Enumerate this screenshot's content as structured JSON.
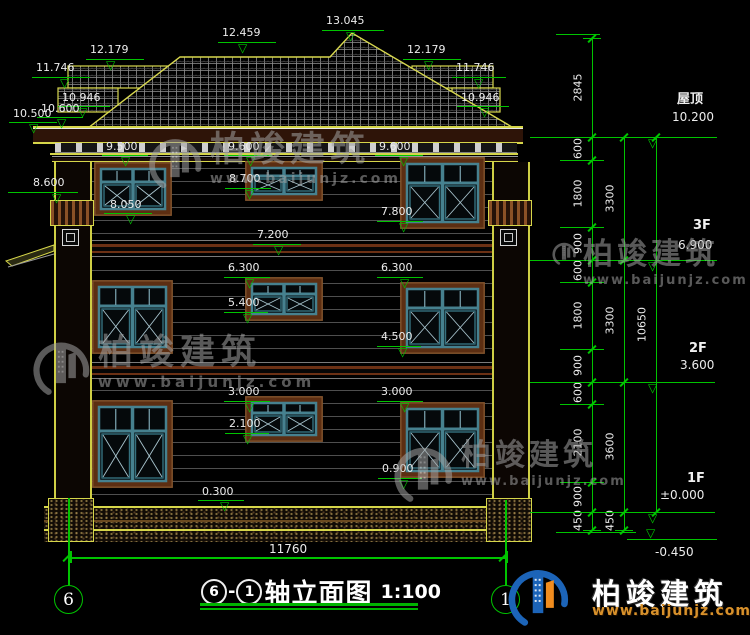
{
  "title": {
    "axis_a": "6",
    "axis_b": "1",
    "dash": "-",
    "name": "轴立面图",
    "scale": "1:100",
    "axis_left_bubble": "6",
    "axis_right_bubble": "1"
  },
  "overall_dim": "11760",
  "brand": {
    "name": "柏竣建筑",
    "url": "www.baijunjz.com"
  },
  "colors": {
    "green": "#00c400",
    "yellow": "#d6d64a",
    "brown": "#5c2e12",
    "teal": "#46818f",
    "watermark": "#a2a2a2",
    "logo_blue": "#1c64b8",
    "logo_orange": "#f08c1e",
    "url_orange": "#d8912b"
  },
  "markers": [
    {
      "t": "13.045",
      "x": 326,
      "y": 15,
      "lx": 322,
      "ly": 30,
      "lw": 62,
      "ax": 346
    },
    {
      "t": "12.459",
      "x": 222,
      "y": 27,
      "lx": 218,
      "ly": 42,
      "lw": 58,
      "ax": 238
    },
    {
      "t": "12.179",
      "x": 90,
      "y": 44,
      "lx": 86,
      "ly": 59,
      "lw": 58,
      "ax": 106
    },
    {
      "t": "11.746",
      "x": 36,
      "y": 62,
      "lx": 32,
      "ly": 77,
      "lw": 58,
      "ax": 60
    },
    {
      "t": "10.946",
      "x": 62,
      "y": 92,
      "lx": 58,
      "ly": 106,
      "lw": 52,
      "ax": 78
    },
    {
      "t": "10.600",
      "x": 41,
      "y": 103,
      "lx": 37,
      "ly": 117,
      "lw": 46,
      "ax": 57
    },
    {
      "t": "10.500",
      "x": 13,
      "y": 108,
      "lx": 9,
      "ly": 122,
      "lw": 48,
      "ax": 29
    },
    {
      "t": "12.179",
      "x": 407,
      "y": 44,
      "lx": 403,
      "ly": 59,
      "lw": 58,
      "ax": 424
    },
    {
      "t": "11.746",
      "x": 456,
      "y": 62,
      "lx": 452,
      "ly": 77,
      "lw": 54,
      "ax": 474
    },
    {
      "t": "10.946",
      "x": 461,
      "y": 92,
      "lx": 457,
      "ly": 106,
      "lw": 52,
      "ax": 480
    },
    {
      "t": "9.500",
      "x": 106,
      "y": 141,
      "lx": 102,
      "ly": 155,
      "lw": 46,
      "ax": 121
    },
    {
      "t": "9.600",
      "x": 228,
      "y": 141,
      "lx": 224,
      "ly": 155,
      "lw": 48,
      "ax": 246
    },
    {
      "t": "9.600",
      "x": 379,
      "y": 141,
      "lx": 375,
      "ly": 155,
      "lw": 48,
      "ax": 399
    },
    {
      "t": "8.700",
      "x": 229,
      "y": 173,
      "lx": 225,
      "ly": 188,
      "lw": 46,
      "ax": 245
    },
    {
      "t": "8.600",
      "x": 33,
      "y": 177,
      "lx": 8,
      "ly": 192,
      "lw": 70,
      "ax": 52
    },
    {
      "t": "8.050",
      "x": 110,
      "y": 199,
      "lx": 104,
      "ly": 213,
      "lw": 48,
      "ax": 126
    },
    {
      "t": "7.800",
      "x": 381,
      "y": 206,
      "lx": 377,
      "ly": 221,
      "lw": 46,
      "ax": 399
    },
    {
      "t": "7.200",
      "x": 257,
      "y": 229,
      "lx": 253,
      "ly": 244,
      "lw": 48,
      "ax": 274
    },
    {
      "t": "6.300",
      "x": 228,
      "y": 262,
      "lx": 224,
      "ly": 277,
      "lw": 46,
      "ax": 245
    },
    {
      "t": "6.300",
      "x": 381,
      "y": 262,
      "lx": 377,
      "ly": 277,
      "lw": 46,
      "ax": 400
    },
    {
      "t": "5.400",
      "x": 228,
      "y": 297,
      "lx": 224,
      "ly": 312,
      "lw": 44,
      "ax": 243
    },
    {
      "t": "4.500",
      "x": 381,
      "y": 331,
      "lx": 377,
      "ly": 346,
      "lw": 44,
      "ax": 398
    },
    {
      "t": "3.000",
      "x": 228,
      "y": 386,
      "lx": 224,
      "ly": 401,
      "lw": 46,
      "ax": 245
    },
    {
      "t": "3.000",
      "x": 381,
      "y": 386,
      "lx": 377,
      "ly": 401,
      "lw": 46,
      "ax": 400
    },
    {
      "t": "2.100",
      "x": 229,
      "y": 418,
      "lx": 225,
      "ly": 433,
      "lw": 44,
      "ax": 243
    },
    {
      "t": "0.900",
      "x": 382,
      "y": 463,
      "lx": 378,
      "ly": 478,
      "lw": 44,
      "ax": 399
    },
    {
      "t": "0.300",
      "x": 202,
      "y": 486,
      "lx": 198,
      "ly": 500,
      "lw": 46,
      "ax": 220
    }
  ],
  "floor_levels": [
    {
      "name": "屋顶",
      "value": "10.200",
      "nx": 677,
      "ny": 88,
      "vx": 672,
      "vy": 110,
      "lx": 637,
      "ly": 137,
      "lw": 80,
      "ax": 648,
      "flip": false
    },
    {
      "name": "3F",
      "value": "6.900",
      "nx": 693,
      "ny": 218,
      "vx": 678,
      "vy": 238,
      "lx": 637,
      "ly": 260,
      "lw": 80,
      "ax": 648,
      "flip": false
    },
    {
      "name": "2F",
      "value": "3.600",
      "nx": 689,
      "ny": 341,
      "vx": 680,
      "vy": 358,
      "lx": 637,
      "ly": 382,
      "lw": 78,
      "ax": 648,
      "flip": false
    },
    {
      "name": "1F",
      "value": "±0.000",
      "nx": 687,
      "ny": 471,
      "vx": 660,
      "vy": 488,
      "lx": 635,
      "ly": 512,
      "lw": 80,
      "ax": 648,
      "flip": false
    },
    {
      "name": "",
      "value": "-0.450",
      "nx": 0,
      "ny": 0,
      "vx": 655,
      "vy": 545,
      "lx": 627,
      "ly": 539,
      "lw": 90,
      "ax": 646,
      "flip": true
    }
  ],
  "chains": [
    {
      "x": 592,
      "segs": [
        {
          "v": "2845",
          "y1": 38,
          "y2": 137
        },
        {
          "v": "600",
          "y1": 137,
          "y2": 160
        },
        {
          "v": "1800",
          "y1": 160,
          "y2": 227
        },
        {
          "v": "900",
          "y1": 227,
          "y2": 260
        },
        {
          "v": "600",
          "y1": 260,
          "y2": 282
        },
        {
          "v": "1800",
          "y1": 282,
          "y2": 349
        },
        {
          "v": "900",
          "y1": 349,
          "y2": 382
        },
        {
          "v": "600",
          "y1": 382,
          "y2": 404
        },
        {
          "v": "2100",
          "y1": 404,
          "y2": 482
        },
        {
          "v": "900",
          "y1": 482,
          "y2": 512
        },
        {
          "v": "450",
          "y1": 512,
          "y2": 530
        }
      ]
    },
    {
      "x": 624,
      "segs": [
        {
          "v": "3300",
          "y1": 137,
          "y2": 260
        },
        {
          "v": "3300",
          "y1": 260,
          "y2": 382
        },
        {
          "v": "3600",
          "y1": 382,
          "y2": 512
        },
        {
          "v": "450",
          "y1": 512,
          "y2": 530
        }
      ]
    },
    {
      "x": 656,
      "segs": [
        {
          "v": "10650",
          "y1": 137,
          "y2": 512
        }
      ]
    }
  ],
  "ext_lines": [
    {
      "y": 34,
      "x1": 556,
      "x2": 600
    },
    {
      "y": 137,
      "x1": 530,
      "x2": 668
    },
    {
      "y": 160,
      "x1": 560,
      "x2": 604
    },
    {
      "y": 227,
      "x1": 560,
      "x2": 604
    },
    {
      "y": 260,
      "x1": 530,
      "x2": 668
    },
    {
      "y": 282,
      "x1": 560,
      "x2": 604
    },
    {
      "y": 349,
      "x1": 560,
      "x2": 604
    },
    {
      "y": 382,
      "x1": 530,
      "x2": 668
    },
    {
      "y": 404,
      "x1": 560,
      "x2": 604
    },
    {
      "y": 482,
      "x1": 560,
      "x2": 604
    },
    {
      "y": 512,
      "x1": 530,
      "x2": 668
    },
    {
      "y": 532,
      "x1": 556,
      "x2": 636
    }
  ],
  "windows": [
    {
      "x": 94,
      "y": 162,
      "w": 78,
      "h": 54
    },
    {
      "x": 245,
      "y": 161,
      "w": 78,
      "h": 40
    },
    {
      "x": 400,
      "y": 157,
      "w": 85,
      "h": 72
    },
    {
      "x": 92,
      "y": 280,
      "w": 81,
      "h": 74
    },
    {
      "x": 245,
      "y": 277,
      "w": 78,
      "h": 44
    },
    {
      "x": 400,
      "y": 282,
      "w": 85,
      "h": 72
    },
    {
      "x": 92,
      "y": 400,
      "w": 81,
      "h": 88
    },
    {
      "x": 245,
      "y": 396,
      "w": 78,
      "h": 46
    },
    {
      "x": 400,
      "y": 402,
      "w": 85,
      "h": 76
    }
  ],
  "watermarks": [
    {
      "x": 146,
      "y": 133,
      "logo": 58,
      "fs": 35,
      "us": 14,
      "ls": 3
    },
    {
      "x": 30,
      "y": 336,
      "logo": 62,
      "fs": 35,
      "us": 15,
      "ls": 4
    },
    {
      "x": 551,
      "y": 240,
      "logo": 26,
      "fs": 30,
      "us": 13,
      "ls": 2
    },
    {
      "x": 391,
      "y": 441,
      "logo": 64,
      "fs": 30,
      "us": 13,
      "ls": 2
    }
  ],
  "siding_ys": [
    168,
    181,
    194,
    207,
    220,
    233,
    270,
    283,
    296,
    309,
    322,
    335,
    348,
    390,
    403,
    416,
    429,
    442,
    455,
    468,
    481,
    494
  ],
  "separator_ys": [
    240,
    362
  ]
}
